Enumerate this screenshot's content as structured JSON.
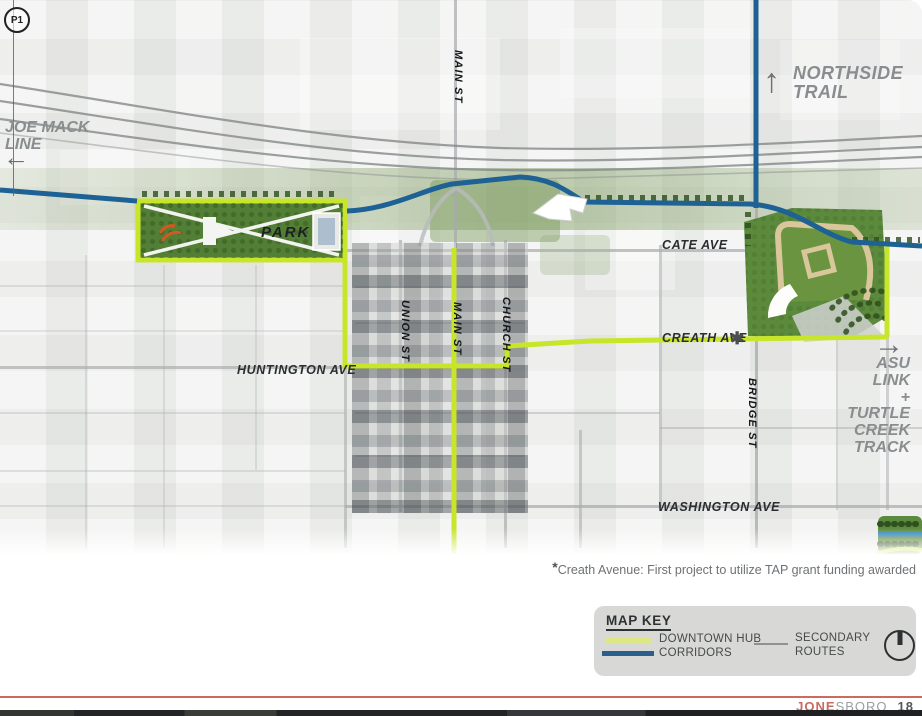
{
  "map": {
    "p1_label": "P1",
    "labels": {
      "joe_mack_1": "JOE MACK",
      "joe_mack_2": "LINE",
      "northside_1": "NORTHSIDE",
      "northside_2": "TRAIL",
      "main_st_top": "MAIN ST",
      "park": "PARK",
      "cate_ave": "CATE AVE",
      "union_st": "UNION ST",
      "main_st": "MAIN ST",
      "church_st": "CHURCH ST",
      "creath_ave": "CREATH AVE",
      "creath_asterisk": "✱",
      "huntington_ave": "HUNTINGTON AVE",
      "bridge_st": "BRIDGE ST",
      "asu_link": [
        "ASU",
        "LINK",
        "+",
        "TURTLE",
        "CREEK",
        "TRACK"
      ],
      "washington_ave": "WASHINGTON AVE"
    },
    "arrows": {
      "joe_mack": "←",
      "northside": "↑",
      "asu": "→"
    },
    "colors": {
      "downtown_hub_line": "#c8e52a",
      "corridor_line": "#1e6195",
      "secondary_road": "#a6a9ab",
      "park_green": "#527f35"
    }
  },
  "footnote": {
    "asterisk": "*",
    "text": "Creath Avenue: First project to utilize TAP grant funding awarded"
  },
  "map_key": {
    "title": "MAP KEY",
    "items": {
      "downtown_hub_line1": "DOWNTOWN HUB",
      "downtown_hub_line2": "CORRIDORS",
      "secondary_line1": "SECONDARY",
      "secondary_line2": "ROUTES"
    },
    "swatches": {
      "downtown_hub": "#dde783",
      "corridor": "#2a5f8c",
      "secondary": "#8f9294"
    }
  },
  "footer": {
    "brand_accent": "JONE",
    "brand_rest": "SBORO",
    "page_number": "18",
    "line_color": "#cb6a60"
  }
}
